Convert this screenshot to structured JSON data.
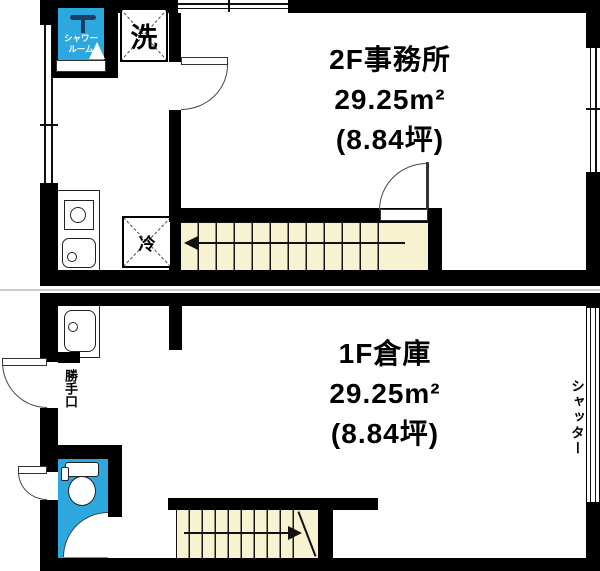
{
  "page": {
    "type": "real-estate floor plan",
    "floors": 2
  },
  "floor2": {
    "name": "2F事務所",
    "area": "29.25m²",
    "tsubo": "(8.84坪)",
    "shower_room_line1": "シャワー",
    "shower_room_line2": "ルーム",
    "washing_machine": "洗",
    "refrigerator": "冷"
  },
  "floor1": {
    "name": "1F倉庫",
    "area": "29.25m²",
    "tsubo": "(8.84坪)",
    "back_door": "勝手口",
    "shutter": "シャッター"
  },
  "colors": {
    "wall": "#000000",
    "wet_area_blue": "#2CA8DF",
    "stairs_cream": "#F7F2CF",
    "shower_fixture_navy": "#1C3F63"
  }
}
